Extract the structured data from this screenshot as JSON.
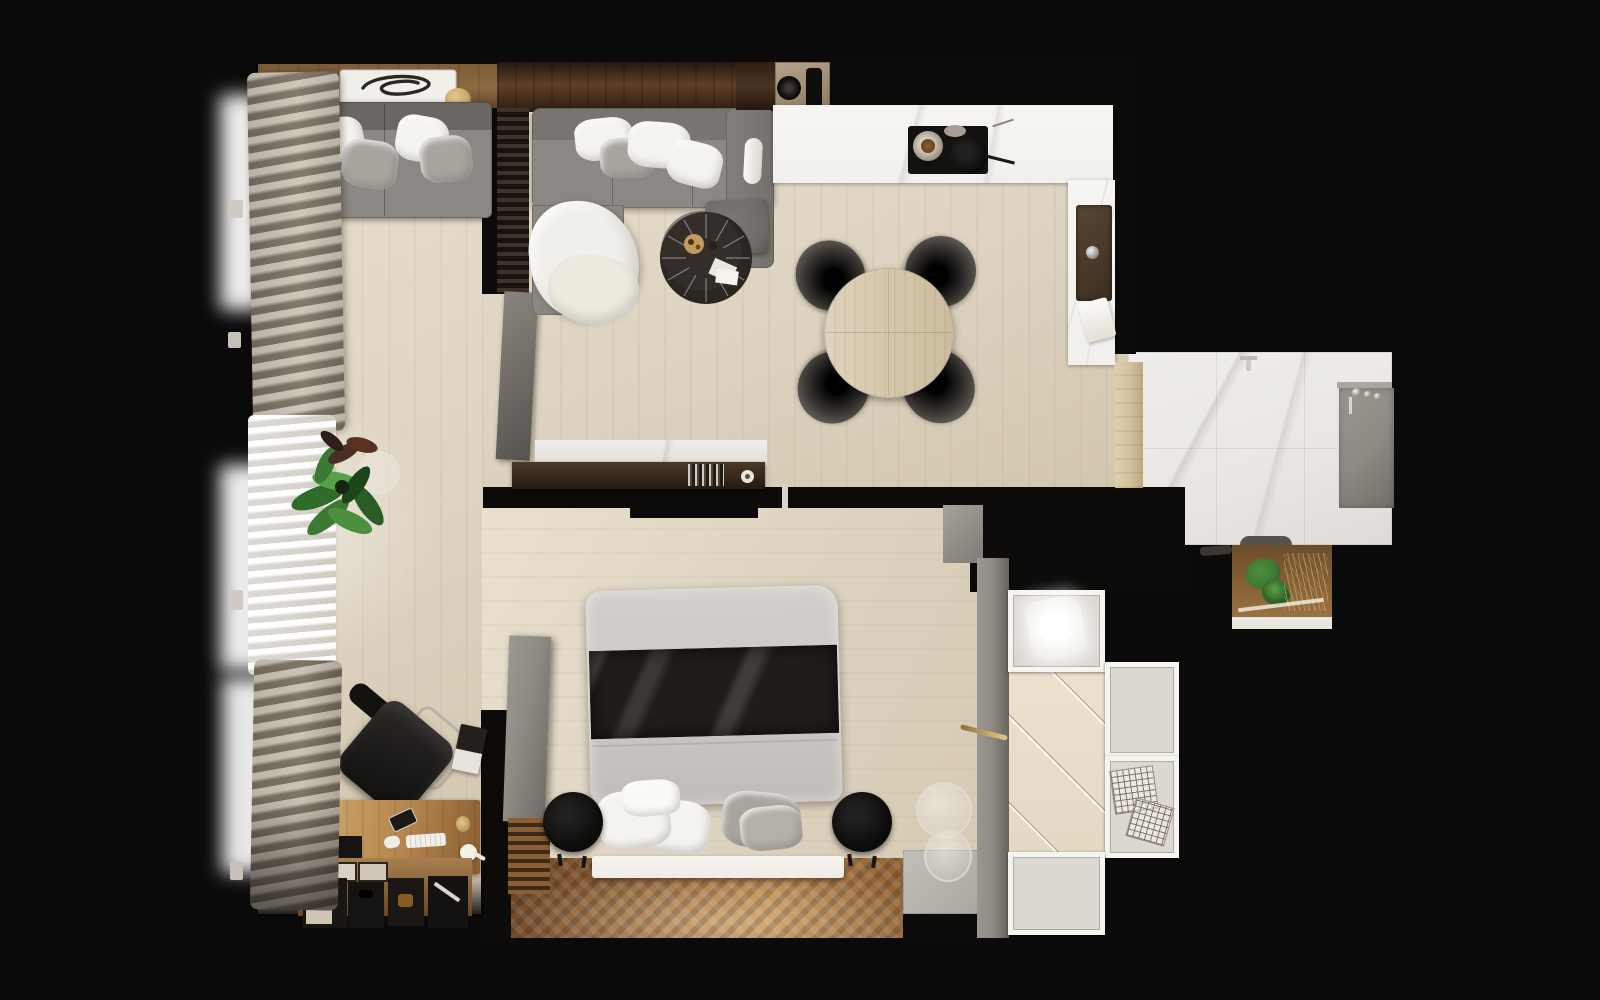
{
  "scene": {
    "title": "Apartment floor plan — top-down 3D render",
    "view": "top-down",
    "background": "#0a0a0a"
  },
  "palette": {
    "background": "#0a0a0a",
    "floor_light": "#ddd3c0",
    "floor_warm": "#b5834b",
    "wall_black": "#0c0b0a",
    "counter_white": "#f2f0ec",
    "marble_bath": "#e9e6e2",
    "sofa_gray": "#8b8782",
    "pillow_white": "#f5f3ee",
    "pillow_gray": "#a9a59e",
    "blanket_white": "#f1efe9",
    "table_black": "#332e29",
    "ottoman_gray": "#6e6a65",
    "dining_wood": "#d5c7ab",
    "chair_black": "#181614",
    "beam_wood": "#5e4127",
    "shelf_wood": "#8e6b42",
    "slat_dark": "#171310",
    "curtain_taupe": "#b0a694",
    "curtain_sheer": "#f4f2ed",
    "bed_duvet": "#cac7c2",
    "bed_runner": "#1f1c19",
    "bed_base": "#efece6",
    "panel_gray": "#8f8b85",
    "desk_wood": "#b5854e",
    "radiator_wood": "#7a5229",
    "closet_floor": "#e7ddc9",
    "cabinet_white": "#efede7",
    "shower_gray": "#8e8a84",
    "door_wood": "#d3c09c",
    "plant_green": "#3c7a33",
    "niche_brown": "#8a6536",
    "brass": "#c8a96a",
    "chrome": "#d9d6d1"
  },
  "rooms": [
    {
      "id": "balcony-lounge",
      "label": "Balcony lounge"
    },
    {
      "id": "living-room",
      "label": "Living room"
    },
    {
      "id": "kitchen",
      "label": "Kitchen"
    },
    {
      "id": "dining-area",
      "label": "Dining area"
    },
    {
      "id": "bedroom",
      "label": "Bedroom"
    },
    {
      "id": "home-office",
      "label": "Home office nook"
    },
    {
      "id": "walk-in-closet",
      "label": "Walk-in closet"
    },
    {
      "id": "bathroom",
      "label": "Bathroom"
    }
  ],
  "furniture": {
    "balcony_lounge": [
      "bench sofa",
      "throw pillows",
      "decor tray",
      "wood shelf",
      "curtains"
    ],
    "living_room": [
      "corner sofa",
      "white throw blanket",
      "round coffee table",
      "velvet ottoman",
      "slat partition",
      "leaning art panel",
      "tv media console",
      "book stack"
    ],
    "kitchen": [
      "l-shaped counter",
      "cooktop",
      "frying pans",
      "sink",
      "faucet",
      "coffee machine",
      "dish towel"
    ],
    "dining_area": [
      "round wood table",
      "four black chairs"
    ],
    "bedroom": [
      "double bed",
      "duvet",
      "dark bed runner",
      "pillows",
      "two round poufs",
      "wardrobe panel",
      "radiator",
      "glass floor decor",
      "floor mat"
    ],
    "home_office": [
      "wood desk",
      "office chair",
      "keyboard",
      "smartphone",
      "storage boxes",
      "magazine",
      "potted plant"
    ],
    "walk_in_closet": [
      "glass display cabinet",
      "wire basket drawers",
      "storage cabinets",
      "shelf rails"
    ],
    "bathroom": [
      "marble floor",
      "walk-in shower",
      "shower set",
      "floor faucet",
      "bath mat",
      "planter niche",
      "wood door"
    ]
  }
}
